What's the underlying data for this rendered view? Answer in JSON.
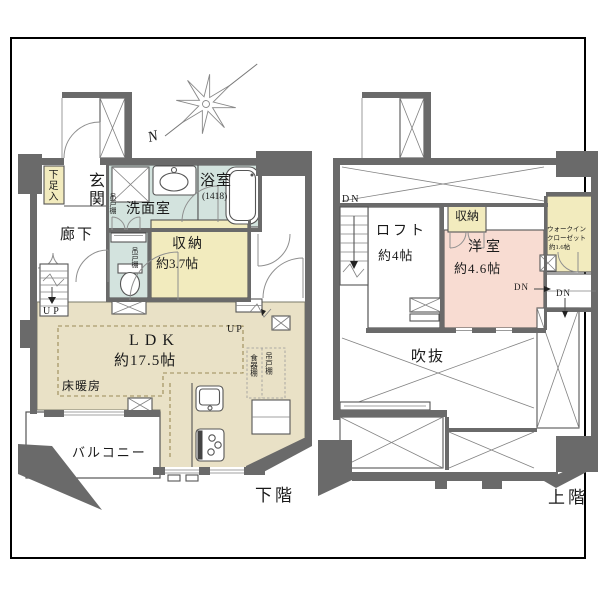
{
  "colors": {
    "wall": "#6a6a6a",
    "ldk": "#e9e1c6",
    "water": "#d3e3de",
    "storage": "#f2ebbe",
    "bedroom": "#f8dcd2",
    "line": "#555555",
    "frame": "#000000"
  },
  "compass": {
    "north": "N"
  },
  "lower_floor": {
    "floor_label": "下階",
    "labels": {
      "shoe_cabinet": "下足入",
      "entrance": "玄関",
      "washroom": "洗面室",
      "hanging_cupboard_a": "吊戸棚",
      "bathroom": "浴室",
      "bathroom_size": "(1418)",
      "corridor": "廊下",
      "hanging_cupboard_b": "吊戸棚",
      "storage": "収納",
      "storage_size": "約3.7帖",
      "up_a": "UP",
      "up_b": "UP",
      "ldk": "LDK",
      "ldk_size": "約17.5帖",
      "floor_heating": "床暖房",
      "dish_cabinet": "食器棚",
      "hanging_cupboard_c": "吊戸棚",
      "balcony": "バルコニー"
    }
  },
  "upper_floor": {
    "floor_label": "上階",
    "labels": {
      "dn_a": "DN",
      "loft": "ロフト",
      "loft_size": "約4帖",
      "storage": "収納",
      "western_room": "洋室",
      "western_room_size": "約4.6帖",
      "wic_line1": "ウォークイン",
      "wic_line2": "クローゼット",
      "wic_line3": "約1.6帖",
      "dn_b": "DN",
      "dn_c": "DN",
      "void": "吹抜"
    }
  }
}
